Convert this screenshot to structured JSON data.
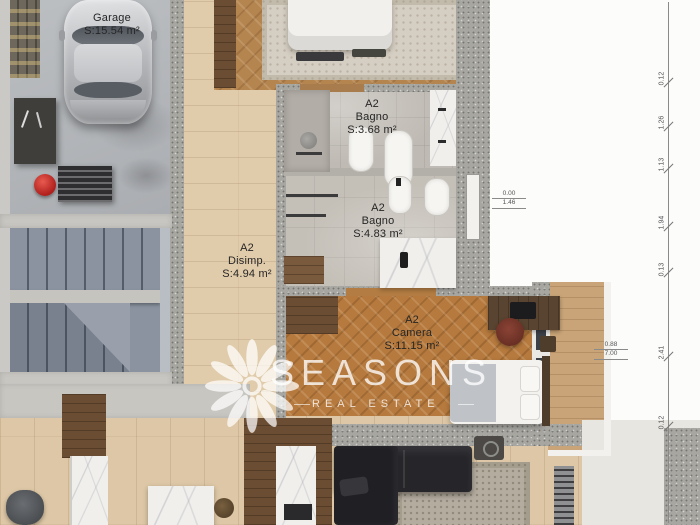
{
  "rooms": {
    "garage": {
      "name": "Garage",
      "area": "S:15.54 m²"
    },
    "bagno_small": {
      "code": "A2",
      "name": "Bagno",
      "area": "S:3.68 m²"
    },
    "bagno_large": {
      "code": "A2",
      "name": "Bagno",
      "area": "S:4.83 m²"
    },
    "disimpegno": {
      "code": "A2",
      "name": "Disimp.",
      "area": "S:4.94 m²"
    },
    "camera": {
      "code": "A2",
      "name": "Camera",
      "area": "S:11.15 m²"
    }
  },
  "annotations": {
    "dimensions": [
      "0.12",
      "1.26",
      "1.13",
      "1.94",
      "0.13",
      "2.41",
      "0.12"
    ],
    "level_markers": [
      {
        "line1": "0.00",
        "line2": "1.46"
      },
      {
        "line1": "0.88",
        "line2": "7.00"
      }
    ]
  },
  "watermark": {
    "brand": "SEASONS",
    "tagline": "REAL ESTATE"
  },
  "colors": {
    "wall_concrete": "#a7a6a1",
    "wood_light": "#ddc7a6",
    "parquet_bedroom": "#b5854f",
    "parquet_camera": "#b6793e",
    "sofa_black": "#232327",
    "emergency_red": "#d0312d",
    "watermark_white": "rgba(255,255,255,0.75)"
  }
}
